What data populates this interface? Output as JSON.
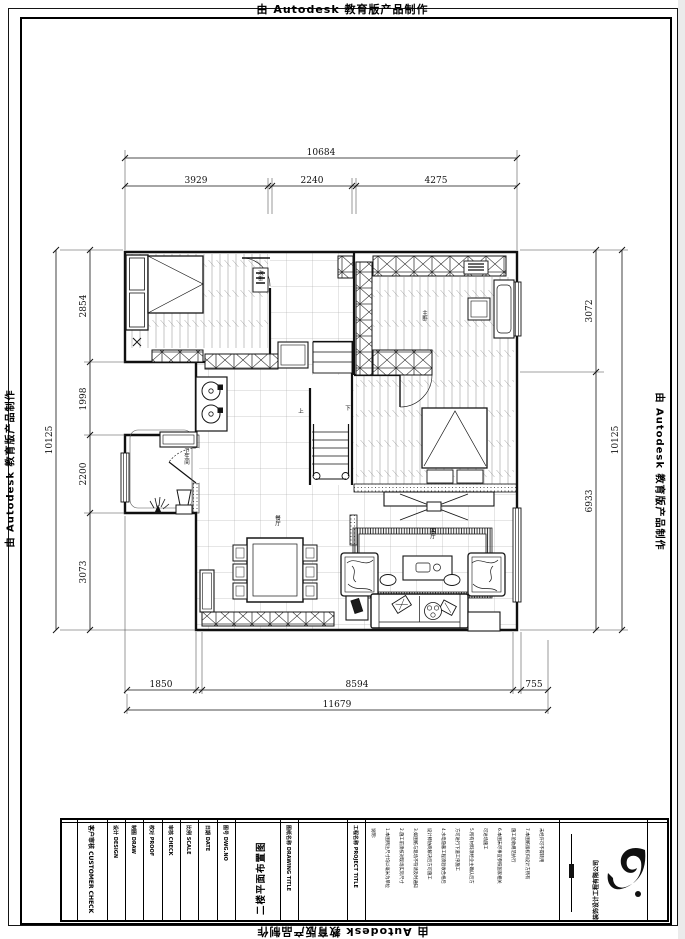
{
  "watermark": {
    "text": "由 Autodesk 教育版产品制作"
  },
  "dimensions": {
    "top": {
      "overall": "10684",
      "segments": [
        "3929",
        "2240",
        "4275"
      ]
    },
    "left": {
      "overall": "10125",
      "segments": [
        "2854",
        "1998",
        "2200",
        "3073"
      ]
    },
    "right": {
      "overall": "10125",
      "segments": [
        "3072",
        "6933"
      ]
    },
    "bottom": {
      "overall": "11679",
      "segments": [
        "1850",
        "8594",
        "755"
      ]
    }
  },
  "rooms": {
    "bedroom2": "次卧",
    "master": "主卧",
    "bath": "卫生间",
    "dining": "餐厅",
    "living": "客厅",
    "stair_up": "上",
    "stair_down": "下"
  },
  "title_block": {
    "customer_check": "客户审核 CUSTOMER CHECK",
    "fields": [
      "设计 DESIGN",
      "制图 DRAW",
      "校对 PROOF",
      "审核 CHECK",
      "比例 SCALE",
      "日期 DATE",
      "图号 DWG.NO"
    ],
    "drawing_title_label": "图纸名称 DRAWING TITLE",
    "drawing_title": "二楼平面布置图",
    "project_label": "工程名称 PROJECT TITLE",
    "notes": [
      "说明:",
      "1.本图所注尺寸均以毫米为单位",
      "2.施工前须核对现场实际尺寸",
      "3.如图纸与现场不符请及时通知",
      "设计师协商解决后方可施工",
      "4.水电隐蔽工程须验收合格后",
      "方可进行下道工序施工",
      "5.所有材料须经业主确认后方",
      "可进场施工",
      "6.本图未尽事宜参照国家相关",
      "施工验收规范执行",
      "7.本图纸版权归设计方所有",
      "未经许可不得转用"
    ],
    "company": "装饰设计工程有限公司"
  }
}
